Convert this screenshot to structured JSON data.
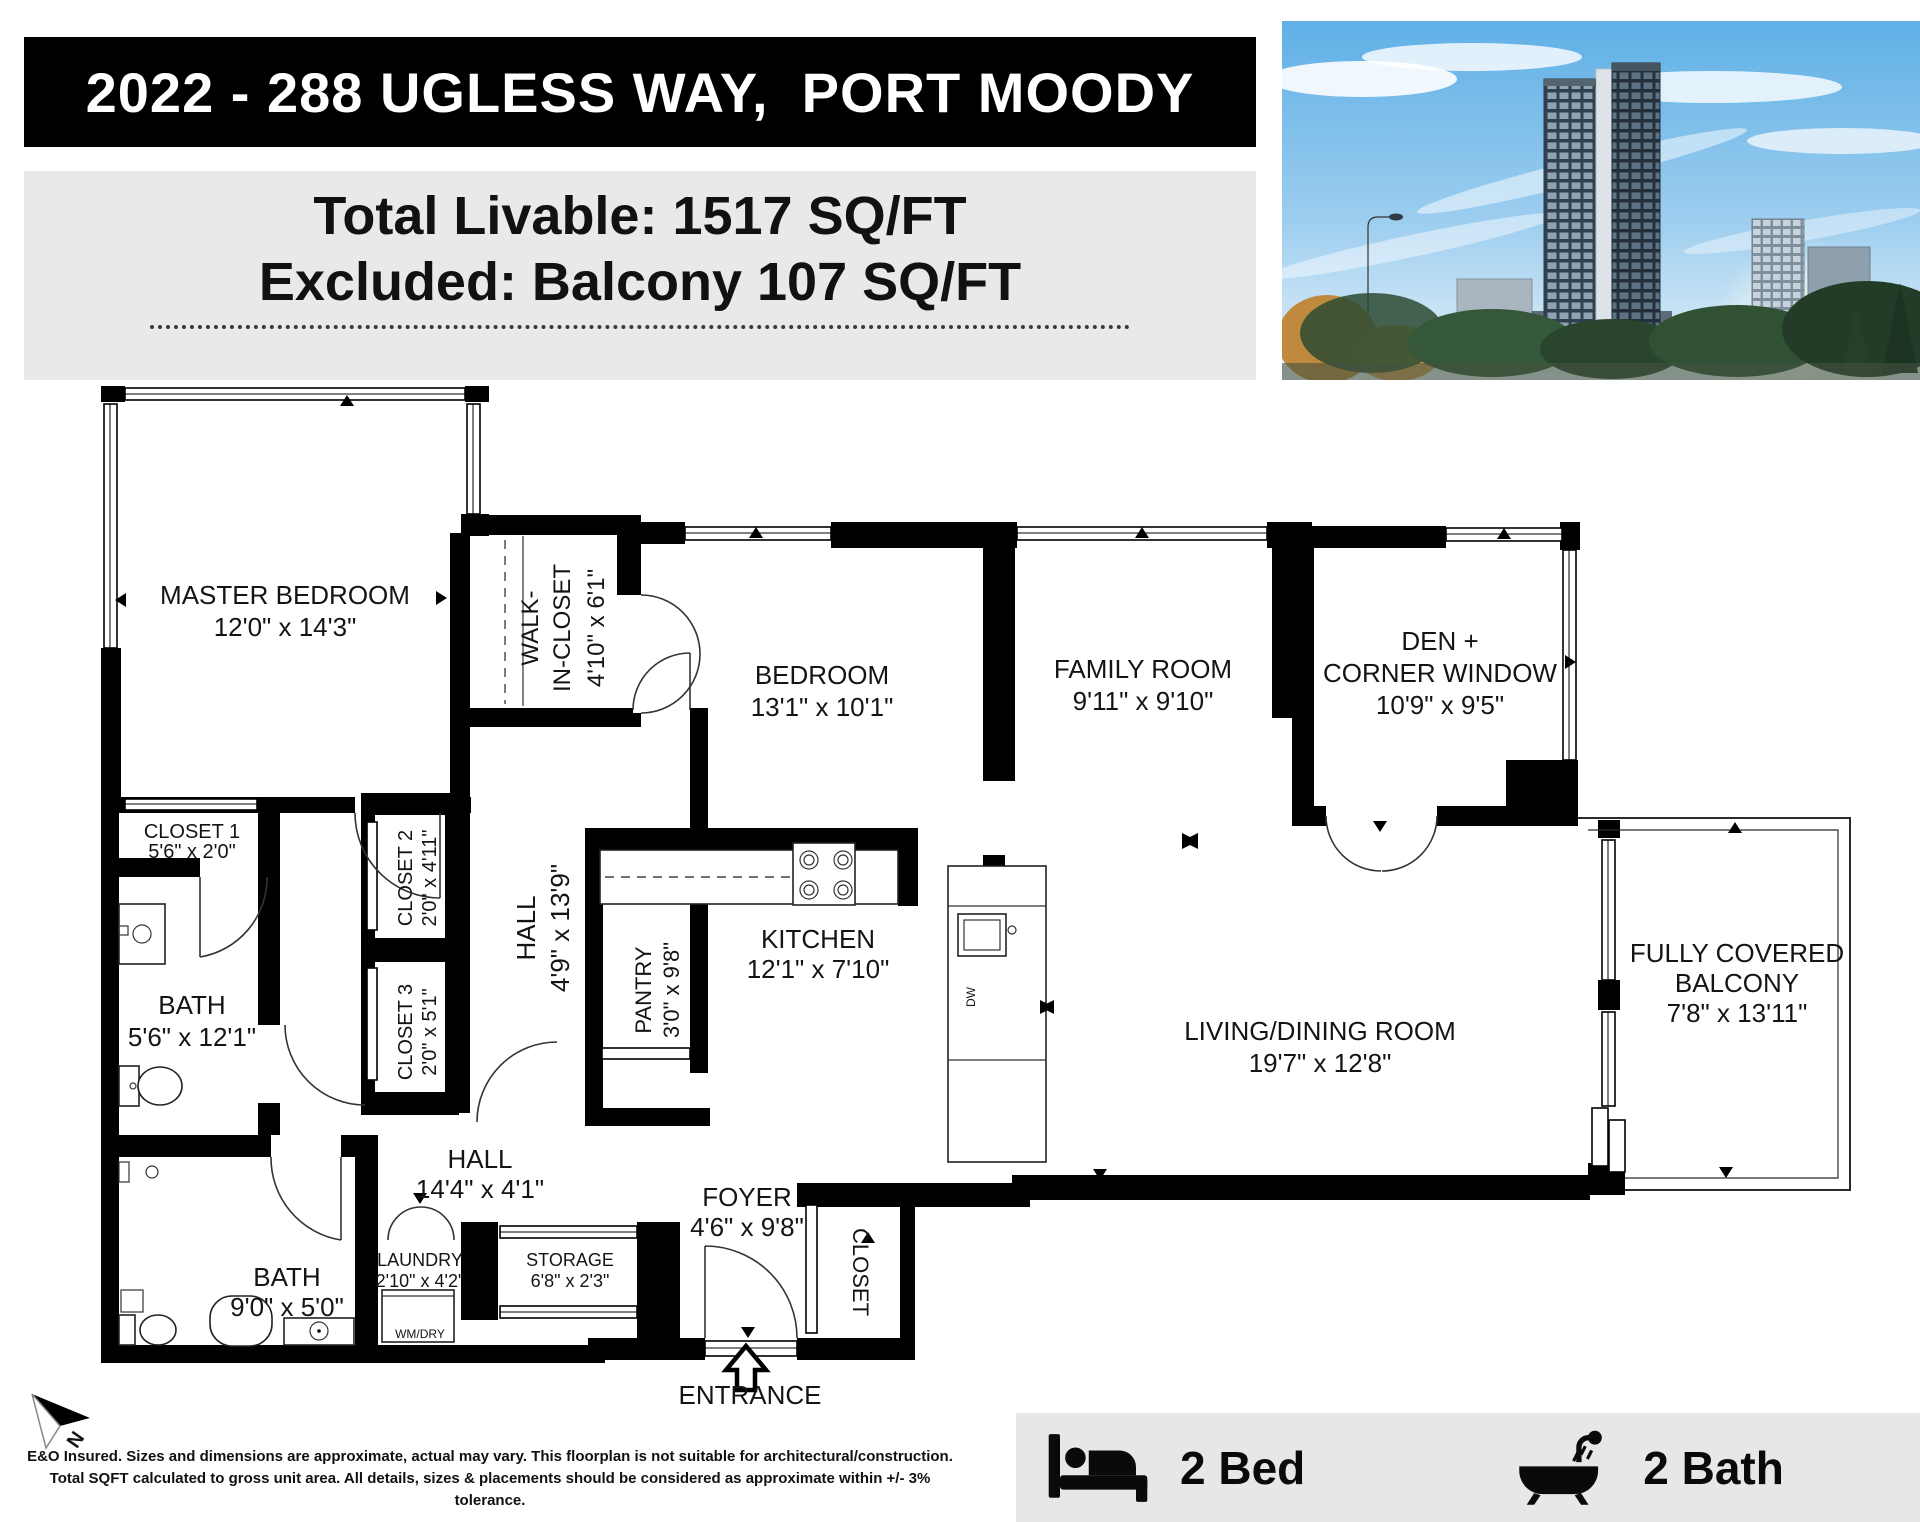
{
  "header": {
    "address": "2022 - 288 UGLESS WAY,  PORT MOODY",
    "total_livable": "Total Livable: 1517 SQ/FT",
    "excluded": "Excluded: Balcony 107  SQ/FT"
  },
  "rooms": {
    "master_bedroom": {
      "name": "MASTER BEDROOM",
      "dims": "12'0\" x 14'3\""
    },
    "walk_in_closet": {
      "name1": "WALK-",
      "name2": "IN-CLOSET",
      "dims": "4'10\" x 6'1\""
    },
    "bedroom": {
      "name": "BEDROOM",
      "dims": "13'1\" x 10'1\""
    },
    "family_room": {
      "name": "FAMILY ROOM",
      "dims": "9'11\" x 9'10\""
    },
    "den": {
      "name1": "DEN +",
      "name2": "CORNER WINDOW",
      "dims": "10'9\" x 9'5\""
    },
    "living_dining": {
      "name": "LIVING/DINING ROOM",
      "dims": "19'7\" x 12'8\""
    },
    "balcony": {
      "name1": "FULLY COVERED",
      "name2": "BALCONY",
      "dims": "7'8\" x 13'11\""
    },
    "kitchen": {
      "name": "KITCHEN",
      "dims": "12'1\" x 7'10\""
    },
    "pantry": {
      "name": "PANTRY",
      "dims": "3'0\" x 9'8\""
    },
    "hall_upper": {
      "name": "HALL",
      "dims": "4'9\" x 13'9\""
    },
    "hall_lower": {
      "name": "HALL",
      "dims": "14'4\" x 4'1\""
    },
    "bath_ensuite": {
      "name": "BATH",
      "dims": "5'6\" x 12'1\""
    },
    "bath_main": {
      "name": "BATH",
      "dims": "9'0\" x 5'0\""
    },
    "closet1": {
      "name": "CLOSET 1",
      "dims": "5'6\" x 2'0\""
    },
    "closet2": {
      "name": "CLOSET 2",
      "dims": "2'0\" x 4'11\""
    },
    "closet3": {
      "name": "CLOSET 3",
      "dims": "2'0\" x 5'1\""
    },
    "closet_foyer": {
      "name": "CLOSET"
    },
    "foyer": {
      "name": "FOYER",
      "dims": "4'6\" x 9'8\""
    },
    "laundry": {
      "name": "LAUNDRY",
      "dims": "2'10\" x 4'2\""
    },
    "storage": {
      "name": "STORAGE",
      "dims": "6'8\" x 2'3\""
    }
  },
  "labels": {
    "entrance": "ENTRANCE",
    "wm_dry": "WM/DRY",
    "dw": "DW",
    "compass_n": "N"
  },
  "disclaimer": {
    "line1": "E&O Insured. Sizes and dimensions are approximate, actual may vary. This floorplan is not suitable for architectural/construction.",
    "line2": "Total SQFT calculated to gross unit area.  All details, sizes & placements should be considered as approximate within +/- 3% tolerance."
  },
  "footer": {
    "bed_count": "2 Bed",
    "bath_count": "2 Bath"
  },
  "colors": {
    "wall": "#000000",
    "header_bg": "#000000",
    "panel_bg": "#e9e9e9",
    "footer_bg": "#e7e7e7",
    "sky": "#7bbde9"
  }
}
